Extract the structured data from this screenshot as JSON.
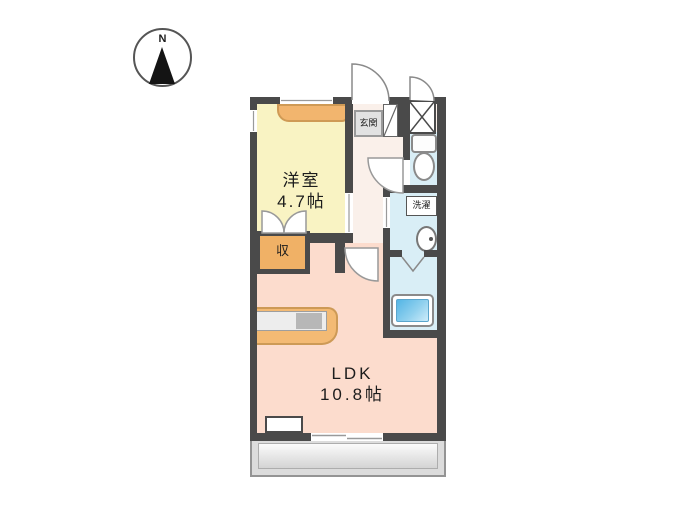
{
  "compass": {
    "label": "N"
  },
  "rooms": {
    "western": {
      "name": "洋室",
      "size": "4.7帖"
    },
    "ldk": {
      "name": "LDK",
      "size": "10.8帖"
    },
    "entrance": {
      "label": "玄関"
    },
    "laundry": {
      "label": "洗濯"
    },
    "storage": {
      "label": "収"
    }
  },
  "colors": {
    "wall": "#4a4a4a",
    "western_floor": "#f9f3c3",
    "ldk_floor": "#fcdccd",
    "hall_floor": "#faf0ea",
    "wet_area_floor": "#d9eef6",
    "closet_orange": "#f2b56e",
    "bathtub_blue": "#54b5e5",
    "balcony_gray": "#dcdcdc",
    "entrance_gray": "#e2e2e2"
  }
}
